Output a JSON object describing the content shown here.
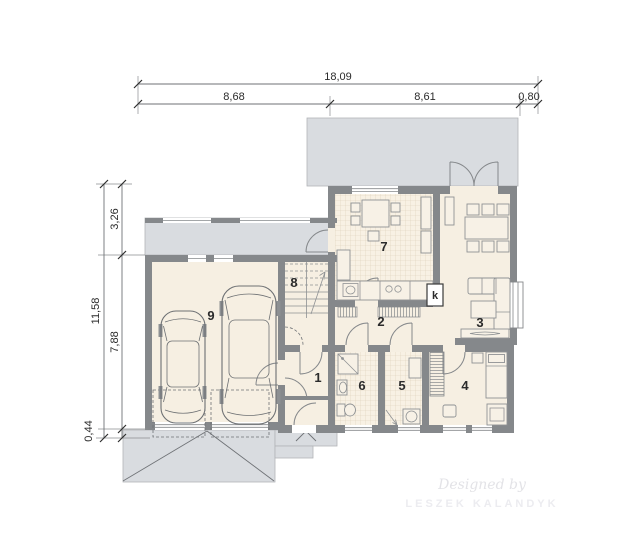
{
  "dimensions": {
    "top_total": "18,09",
    "top_seg1": "8,68",
    "top_seg2": "8,61",
    "top_seg3": "0,80",
    "left_total": "11,58",
    "left_seg1": "3,26",
    "left_seg2": "7,88",
    "left_seg3": "0,44"
  },
  "rooms": {
    "entry_hall": "1",
    "hallway": "2",
    "living_room": "3",
    "bedroom": "4",
    "utility_room": "5",
    "bathroom": "6",
    "kitchen": "7",
    "staircase": "8",
    "garage": "9"
  },
  "annotations": {
    "fireplace": "k"
  },
  "watermark": {
    "line1": "Designed by",
    "line2": "LESZEK KALANDYK"
  },
  "colors": {
    "wall": "#85888b",
    "paved_area": "#d9dce0",
    "floor": "#f6efe2",
    "dimension_text": "#2b2b2b"
  }
}
